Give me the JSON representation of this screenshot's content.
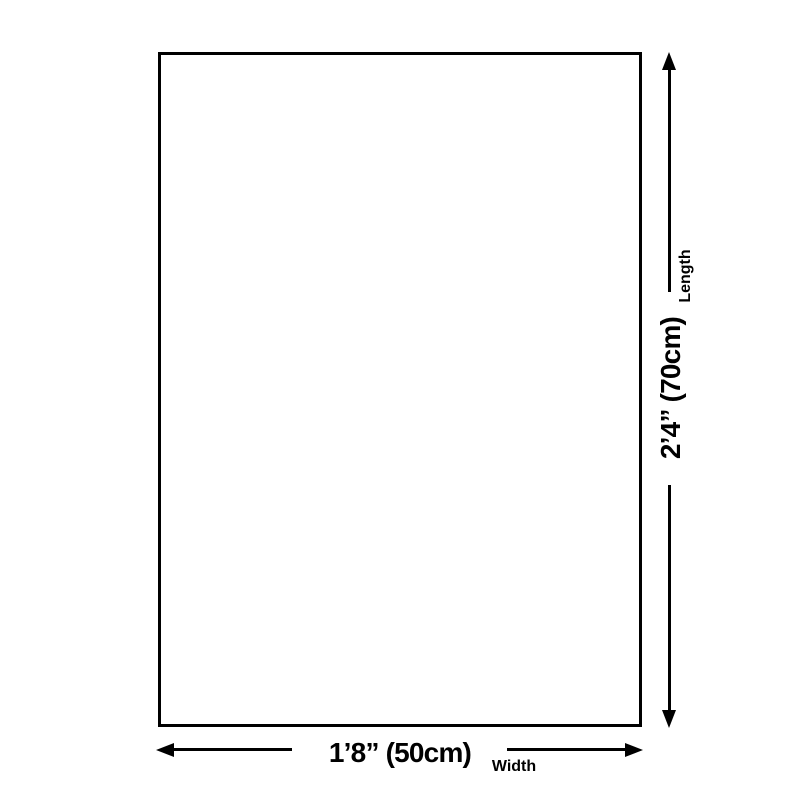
{
  "theme": {
    "line_color": "#000000",
    "background": "#ffffff"
  },
  "diagram": {
    "length": {
      "value": "2’4” (70cm)",
      "label": "Length"
    },
    "width": {
      "value": "1’8” (50cm)",
      "label": "Width"
    }
  }
}
